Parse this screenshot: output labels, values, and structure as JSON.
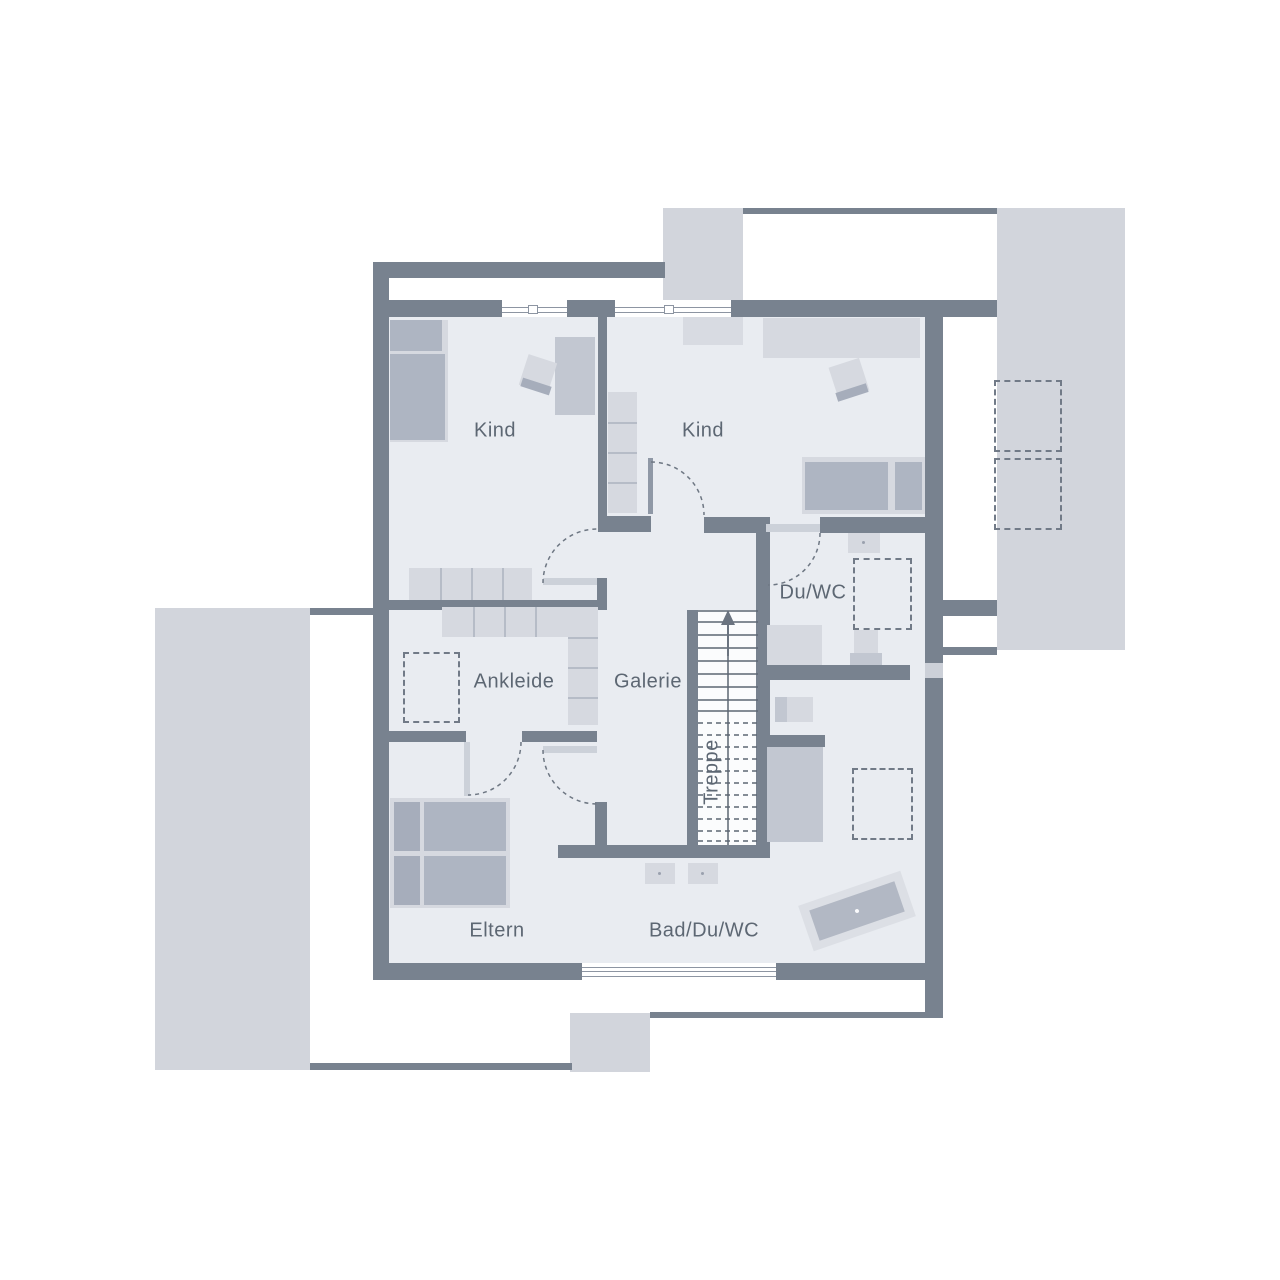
{
  "plan": {
    "type": "floor-plan",
    "floor": "upper",
    "rooms": [
      {
        "id": "kind-left",
        "label": "Kind"
      },
      {
        "id": "kind-right",
        "label": "Kind"
      },
      {
        "id": "du-wc",
        "label": "Du/WC"
      },
      {
        "id": "ankleide",
        "label": "Ankleide"
      },
      {
        "id": "galerie",
        "label": "Galerie"
      },
      {
        "id": "treppe",
        "label": "Treppe"
      },
      {
        "id": "eltern",
        "label": "Eltern"
      },
      {
        "id": "bad-du-wc",
        "label": "Bad/Du/WC"
      }
    ],
    "colors": {
      "wall": "#78828f",
      "floor": "#e9ecf1",
      "terrace": "#d2d5dc",
      "furniture_light": "#d6d9e0",
      "furniture_mid": "#c2c7d1",
      "furniture_dark": "#aeb5c2",
      "dash": "#717a87",
      "text": "#5d6773",
      "background": "#ffffff"
    }
  }
}
